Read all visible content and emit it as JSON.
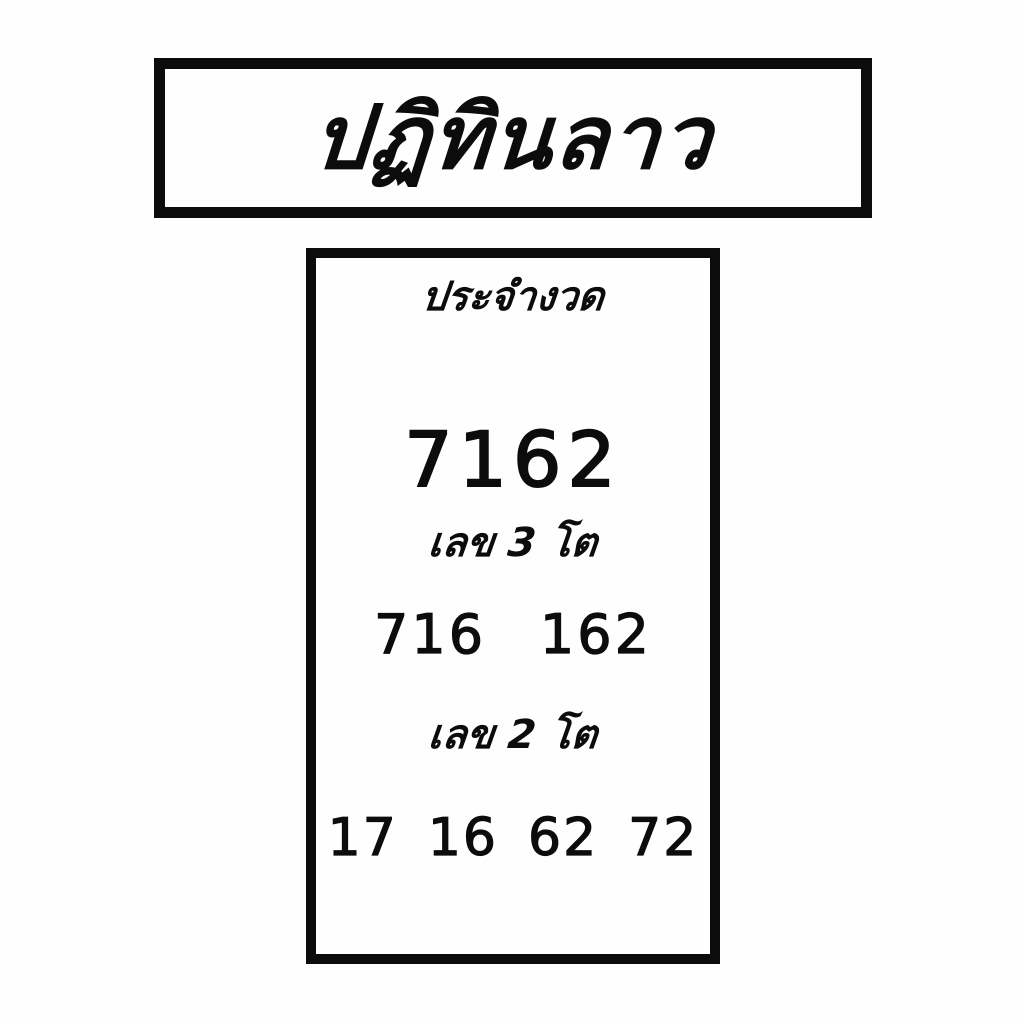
{
  "colors": {
    "ink": "#0c0c0c",
    "background": "#fefefe"
  },
  "title_banner": {
    "text": "ปฏิทินลาว"
  },
  "draw_card": {
    "header": "ประจำงวด",
    "main_number": "7162",
    "three_digit": {
      "label": "เลข 3 โต",
      "numbers": [
        "716",
        "162"
      ]
    },
    "two_digit": {
      "label": "เลข 2 โต",
      "numbers": [
        "17",
        "16",
        "62",
        "72"
      ]
    }
  }
}
